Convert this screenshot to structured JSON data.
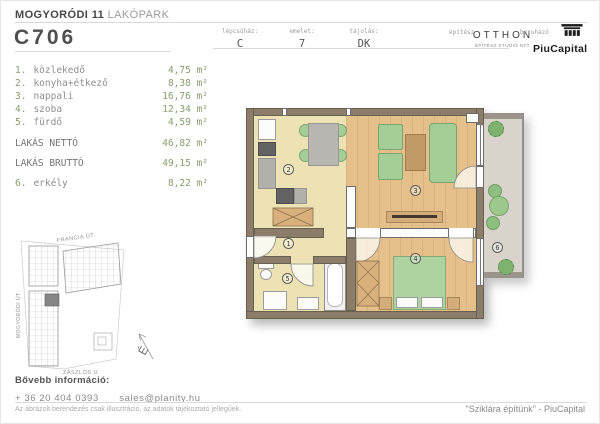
{
  "header": {
    "project_title_bold": "MOGYORÓDI 11",
    "project_title_light": "LAKÓPARK",
    "unit_code": "C706",
    "meta": [
      {
        "label": "lépcsőház:",
        "value": "C"
      },
      {
        "label": "emelet:",
        "value": "7"
      },
      {
        "label": "tájolás:",
        "value": "DK"
      }
    ],
    "architect": {
      "label": "építész",
      "name": "OTTHON",
      "subtitle": "ÉPÍTÉSZ STÚDIÓ KFT."
    },
    "developer": {
      "label": "beruházó",
      "name": "PiuCapital"
    }
  },
  "area_list": {
    "rooms": [
      {
        "num": "1.",
        "name": "közlekedő",
        "area": "4,75 m²"
      },
      {
        "num": "2.",
        "name": "konyha+étkező",
        "area": "8,38 m²"
      },
      {
        "num": "3.",
        "name": "nappali",
        "area": "16,76 m²"
      },
      {
        "num": "4.",
        "name": "szoba",
        "area": "12,34 m²"
      },
      {
        "num": "5.",
        "name": "fürdő",
        "area": "4,59 m²"
      }
    ],
    "totals": [
      {
        "label": "LAKÁS NETTÓ",
        "area": "46,82 m²"
      },
      {
        "label": "LAKÁS BRUTTÓ",
        "area": "49,15 m²"
      }
    ],
    "balcony": {
      "num": "6.",
      "name": "erkély",
      "area": "8,22 m²"
    }
  },
  "floorplan": {
    "room_labels": [
      "1",
      "2",
      "3",
      "4",
      "5",
      "6"
    ]
  },
  "siteplan": {
    "street_top": "FRANCIA ÚT",
    "street_left": "MOGYORÓDI ÚT",
    "street_bottom": "ZÁSZLÓS U.",
    "compass": "É"
  },
  "footer": {
    "info_label": "Bővebb információ:",
    "phone": "+ 36 20 404 0393",
    "email": "sales@planity.hu",
    "disclaimer": "Az ábrázolt berendezés csak illusztráció, az adatok tájékoztató jellegűek.",
    "slogan": "\"Sziklára építünk\" - PiuCapital"
  },
  "colors": {
    "accent_green": "#84a06b",
    "wall_brown": "#8b7d6a",
    "floor_wood": "#e6c08b",
    "floor_yellow": "#ece2b4",
    "floor_balcony": "#d8d4cb",
    "furniture_green": "#a5cd97"
  }
}
